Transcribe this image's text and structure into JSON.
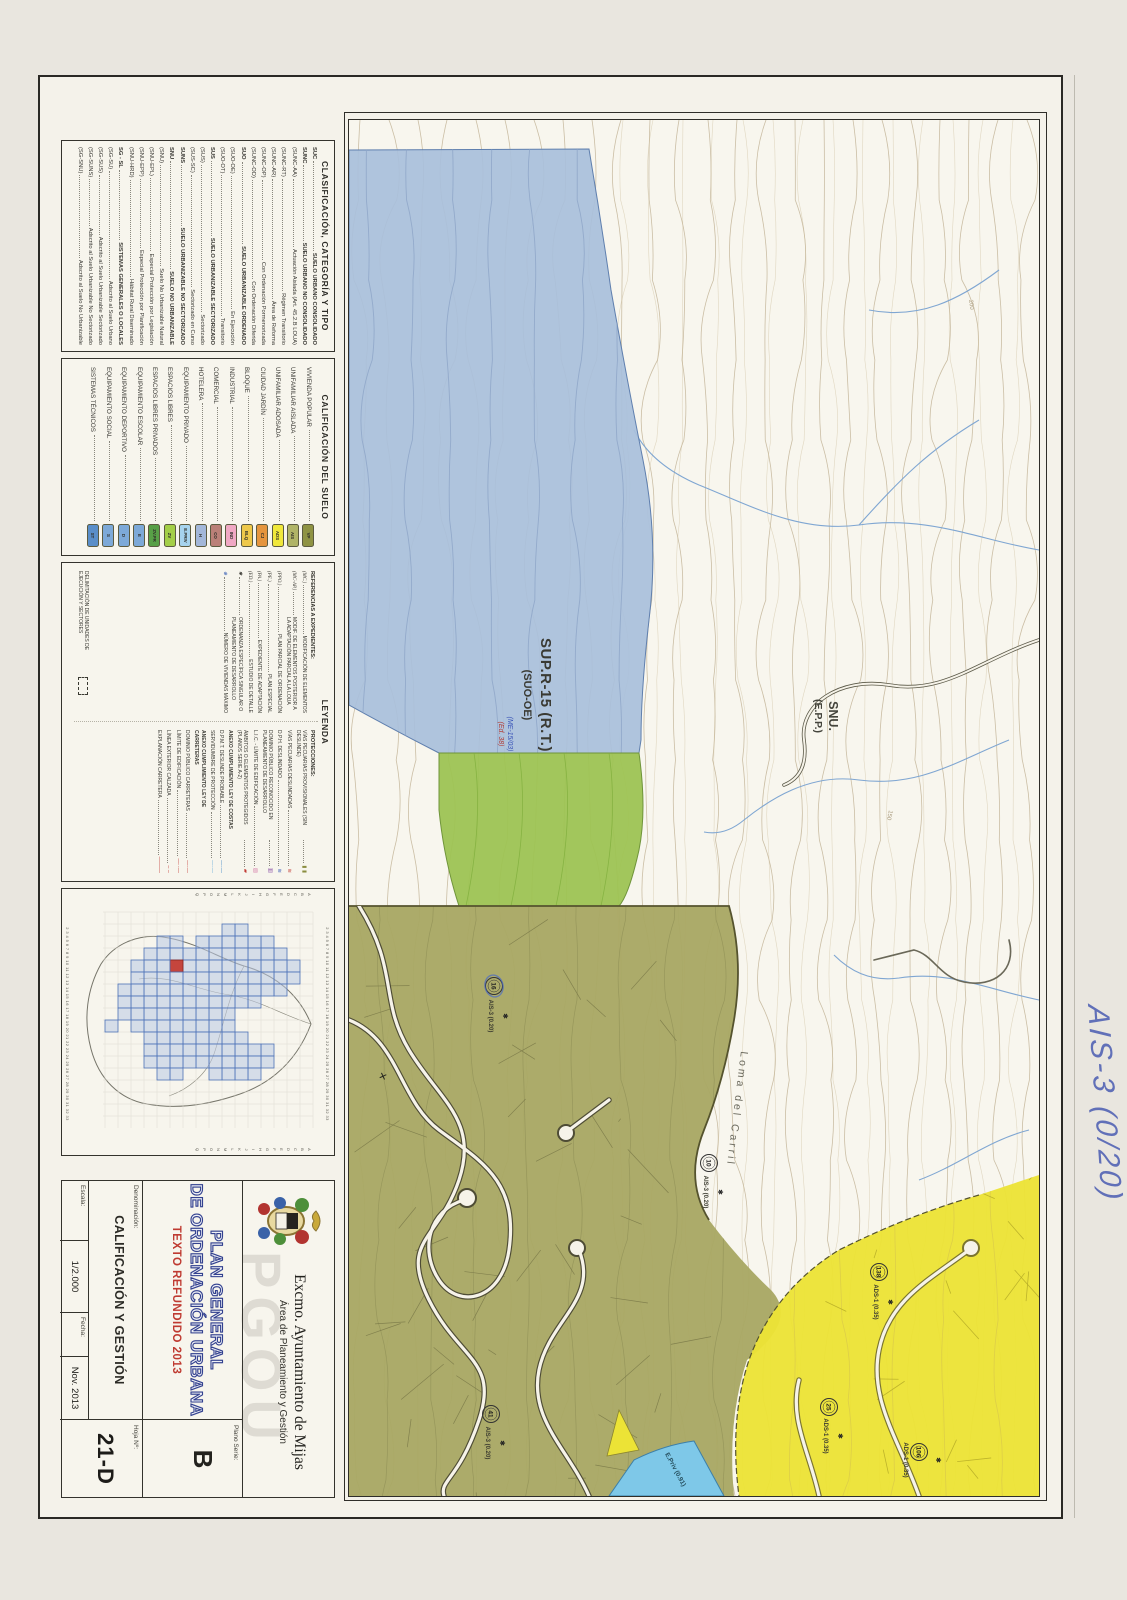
{
  "clasificacion": {
    "title": "CLASIFICACIÓN, CATEGORÍA Y TIPO",
    "rows": [
      {
        "code": "SUC",
        "desc": "SUELO URBANO CONSOLIDADO",
        "w": "bold"
      },
      {
        "code": "SUNC",
        "desc": "SUELO URBANO NO CONSOLIDADO",
        "w": "bold"
      },
      {
        "code": "(SUNC-AA)",
        "desc": "Actuación Aislada (Art. 45.2.B LOUA)",
        "w": "normal"
      },
      {
        "code": "(SUNC-RT)",
        "desc": "Régimen Transitorio",
        "w": "normal"
      },
      {
        "code": "(SUNC-AR)",
        "desc": "Área de Reforma",
        "w": "normal"
      },
      {
        "code": "(SUNC-OP)",
        "desc": "Con Ordenación Pormenorizada",
        "w": "normal"
      },
      {
        "code": "(SUNC-OD)",
        "desc": "Con Ordenación Diferida",
        "w": "normal"
      },
      {
        "code": "SUO",
        "desc": "SUELO URBANIZABLE ORDENADO",
        "w": "bold"
      },
      {
        "code": "(SUO-OE)",
        "desc": "En Ejecución",
        "w": "normal"
      },
      {
        "code": "(SUO-OT)",
        "desc": "Transitorio",
        "w": "normal"
      },
      {
        "code": "SUS",
        "desc": "SUELO URBANIZABLE SECTORIZADO",
        "w": "bold"
      },
      {
        "code": "(SUS)",
        "desc": "Sectorizado",
        "w": "normal"
      },
      {
        "code": "(SUS-SC)",
        "desc": "Sectorizado en Curso",
        "w": "normal"
      },
      {
        "code": "SUNS",
        "desc": "SUELO URBANIZABLE NO SECTORIZADO",
        "w": "bold"
      },
      {
        "code": "SNU",
        "desc": "SUELO NO URBANIZABLE",
        "w": "bold"
      },
      {
        "code": "(SNU)",
        "desc": "Suelo No Urbanizable Natural",
        "w": "normal"
      },
      {
        "code": "(SNU-EPL)",
        "desc": "Especial Protección por Legislación",
        "w": "normal"
      },
      {
        "code": "(SNU-EPP)",
        "desc": "Especial Protección por Planificación",
        "w": "normal"
      },
      {
        "code": "(SNU-HRD)",
        "desc": "Hábitat Rural Diseminado",
        "w": "normal"
      },
      {
        "code": "SG - SL",
        "desc": "SISTEMAS GENERALES O LOCALES",
        "w": "bold"
      },
      {
        "code": "(SG-SU)",
        "desc": "Adscrito al Suelo Urbano",
        "w": "normal"
      },
      {
        "code": "(SG-SUS)",
        "desc": "Adscrito al Suelo Urbanizable Sectorizado",
        "w": "normal"
      },
      {
        "code": "(SG-SUNS)",
        "desc": "Adscrito al Suelo Urbanizable No Sectorizado",
        "w": "normal"
      },
      {
        "code": "(SG-SNU)",
        "desc": "Adscrito al Suelo No Urbanizable",
        "w": "normal"
      }
    ]
  },
  "calificacion": {
    "title": "CALIFICACIÓN DEL SUELO",
    "rows": [
      {
        "label": "VIVIENDA POPULAR",
        "code": "VP",
        "color": "#8f9343"
      },
      {
        "label": "UNIFAMILIAR AISLADA",
        "code": "AIS",
        "color": "#b0b467"
      },
      {
        "label": "UNIFAMILIAR ADOSADA",
        "code": "ADS",
        "color": "#f0e83b"
      },
      {
        "label": "CIUDAD JARDÍN",
        "code": "CJ",
        "color": "#e5953e"
      },
      {
        "label": "BLOQUE",
        "code": "BLQ",
        "color": "#eec84a"
      },
      {
        "label": "INDUSTRIAL",
        "code": "IND",
        "color": "#f0a8c4"
      },
      {
        "label": "COMERCIAL",
        "code": "CO",
        "color": "#bb8078"
      },
      {
        "label": "HOTELERA",
        "code": "H",
        "color": "#a3b7d9"
      },
      {
        "label": "EQUIPAMIENTO PRIVADO",
        "code": "E.PRIV",
        "color": "#a6d3ee"
      },
      {
        "label": "ESPACIOS LIBRES",
        "code": "ZV",
        "color": "#a4cf48"
      },
      {
        "label": "ESPACIOS LIBRES PRIVADOS",
        "code": "ZV.PR",
        "color": "#58a047"
      },
      {
        "label": "EQUIPAMIENTO ESCOLAR",
        "code": "E",
        "color": "#7da9d8"
      },
      {
        "label": "EQUIPAMIENTO DEPORTIVO",
        "code": "D",
        "color": "#7da9d8"
      },
      {
        "label": "EQUIPAMIENTO SOCIAL",
        "code": "S",
        "color": "#7da9d8"
      },
      {
        "label": "SISTEMAS TÉCNICOS",
        "code": "ST",
        "color": "#5a8ec9"
      }
    ]
  },
  "leyenda": {
    "title": "LEYENDA",
    "referencias_header": "REFERENCIAS A EXPEDIENTES:",
    "referencias": [
      {
        "code": "(MC.)",
        "desc": "MODIFICACIÓN DE ELEMENTOS"
      },
      {
        "code": "(MC-AP.)",
        "desc": "MODIF. DE ELEMENTOS POSTERIOR A LA ADAPTACIÓN PARCIAL A LA LOUA"
      },
      {
        "code": "(PPO.)",
        "desc": "PLAN PARCIAL DE ORDENACIÓN"
      },
      {
        "code": "(PE.)",
        "desc": "PLAN ESPECIAL"
      },
      {
        "code": "(PA.)",
        "desc": "EXPEDIENTE DE ADAPTACIÓN"
      },
      {
        "code": "(ED.)",
        "desc": "ESTUDIO DE DETALLE"
      },
      {
        "code": "✱",
        "desc": "ORDENANZA ESPECÍFICA SINGULAR O PLANEAMIENTO DE DESARROLLO"
      },
      {
        "code": "⊕",
        "desc": "NÚMERO DE VIVIENDAS MÁXIMO",
        "cc": "#2b55b0"
      }
    ],
    "delimitacion": "DELIMITACIÓN DE UNIDADES DE EJECUCIÓN Y SECTORES",
    "protecciones_header": "PROTECCIONES:",
    "protecciones": [
      {
        "sym": "▮ ▮",
        "color": "#8a8d3f",
        "desc": "VÍAS PECUARIAS PROVISIONALES (SIN DESLINDE)"
      },
      {
        "sym": "≋",
        "color": "#c23b34",
        "desc": "VÍAS PECUARIAS DESLINDADAS"
      },
      {
        "sym": "≋",
        "color": "#3757b5",
        "desc": "D.P.H. DESLINDADO"
      },
      {
        "sym": "▥",
        "color": "#8e56a8",
        "desc": "DOMINIO PÚBLICO RECONOCIDO EN PLANEAMIENTO DE DESARROLLO"
      },
      {
        "sym": "▨",
        "color": "#d886ae",
        "desc": "L.I.C. - LÍMITE DE EDIFICACIÓN"
      },
      {
        "sym": "▰",
        "color": "#c23b34",
        "desc": "ÁMBITOS O ELEMENTOS PROTEGIDOS (PLANOS SERIE A-2)"
      },
      {
        "desc": "ANEXO CUMPLIMIENTO LEY DE COSTAS",
        "w": "bold",
        "hide": "none"
      },
      {
        "sym": "—·—",
        "color": "#3b82c4",
        "desc": "D.P.M.T. DESLINDE PROBABLE"
      },
      {
        "sym": "—·—",
        "color": "#63a9d8",
        "desc": "SERVIDUMBRE DE PROTECCIÓN"
      },
      {
        "desc": "ANEXO CUMPLIMIENTO LEY DE CARRETERAS",
        "w": "bold",
        "hide": "none"
      },
      {
        "sym": "—·—",
        "color": "#c23b34",
        "desc": "DOMINIO PÚBLICO CARRETERAS"
      },
      {
        "sym": "—··—",
        "color": "#c23b34",
        "desc": "LÍMITE DE EDIFICACIÓN"
      },
      {
        "sym": "– –",
        "color": "#c23b34",
        "desc": "LÍNEA EXTERIOR CALZADA"
      },
      {
        "sym": "———",
        "color": "#c23b34",
        "desc": "EXPLANACIÓN CARRETERA"
      }
    ]
  },
  "overview": {
    "numbers": "2 3 4 5 6 7 8 9 10 11 12 13 14 15 16 17 18 19 20 21 22 23 24 25 26 27 28 29 30 31 32 33",
    "letters": "ABCDEFGHIJKLMNOPQ"
  },
  "titleblock": {
    "org": "Excmo. Ayuntamiento de Mijas",
    "dept": "Área de Planeamiento y Gestión",
    "watermark": "PGOU",
    "title1": "PLAN GENERAL",
    "title2": "DE ORDENACIÓN URBANA",
    "subtitle": "TEXTO REFUNDIDO 2013",
    "plano_serie_label": "Plano Serie:",
    "plano_serie": "B",
    "denominacion_label": "Denominación:",
    "denominacion": "CALIFICACIÓN Y GESTIÓN",
    "hoja_label": "Hoja Nº:",
    "hoja": "21-D",
    "escala_label": "Escala:",
    "escala": "1/2.000",
    "fecha_label": "Fecha:",
    "fecha": "Nov. 2013"
  },
  "map": {
    "sup_label": "SUP.R-15 (R.T.)",
    "suo_label": "(SUO-OE)",
    "exp_ref_1": "(ME-15/03)",
    "exp_ref_2": "(Ed. 38)",
    "snu_label": "SNU.",
    "epp_label": "(E.P.P.)",
    "loma_label": "Loma del Carril",
    "contour_a": "200",
    "contour_b": "150",
    "epriv_label": "E.Priv (0.91)",
    "note": "AIS-3 (0/20)",
    "markers": [
      {
        "sym": "✱",
        "label": "AIS-3 (0.20)",
        "num": "16"
      },
      {
        "sym": "✱",
        "label": "AIS-3 (0.20)",
        "num": "10"
      },
      {
        "sym": "✱",
        "label": "ADS-1 (0.35)",
        "num": "138"
      },
      {
        "sym": "✱",
        "label": "ADS-1 (0.35)",
        "num": "25"
      },
      {
        "sym": "✱",
        "label": "ADS-1 (0.35)",
        "num": "106"
      },
      {
        "sym": "✱",
        "label": "AIS-3 (0.20)",
        "num": "41"
      }
    ]
  }
}
